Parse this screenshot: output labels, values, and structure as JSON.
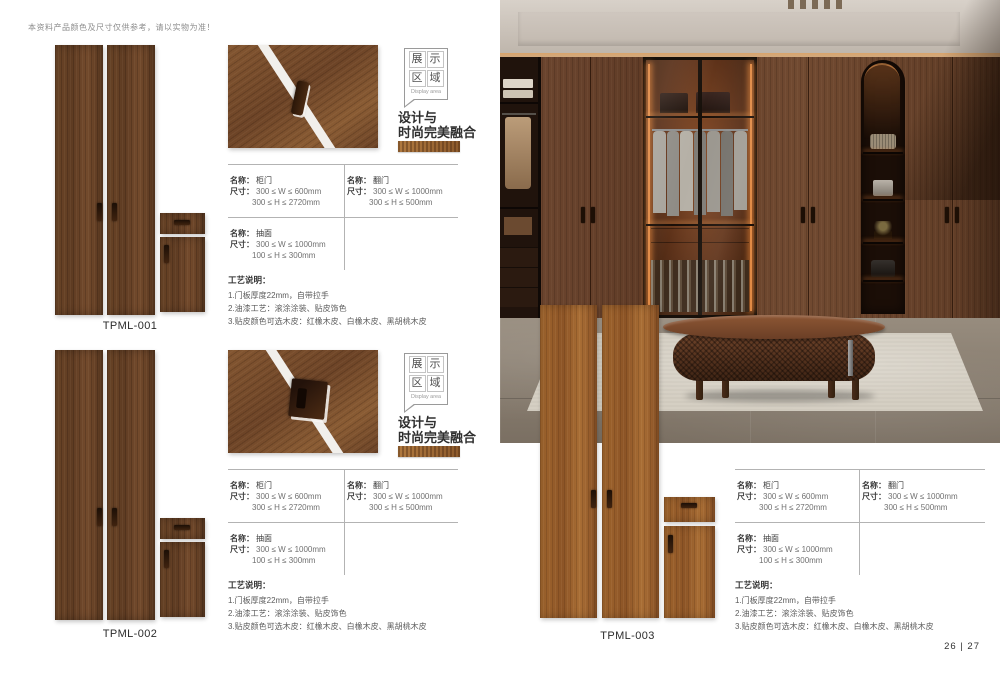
{
  "page": {
    "disclaimer": "本资料产品颜色及尺寸仅供参考，请以实物为准！",
    "page_number": "26 | 27"
  },
  "labels": {
    "name": "名称：",
    "size": "尺寸："
  },
  "badge": {
    "chars": [
      "展",
      "示",
      "区",
      "域"
    ],
    "subtitle": "Display area"
  },
  "tagline": {
    "line1": "设计与",
    "line2": "时尚完美融合"
  },
  "craft": {
    "title": "工艺说明：",
    "line1": "1.门板厚度22mm，自带拉手",
    "line2": "2.油漆工艺：滚涂涂装、贴皮饰色",
    "line3": "3.贴皮颜色可选木皮：红橡木皮、白橡木皮、黑胡桃木皮"
  },
  "specs": {
    "cabinet_door": {
      "name": "柜门",
      "w": "300 ≤ W ≤ 600mm",
      "h": "300 ≤ H ≤ 2720mm"
    },
    "flip_door": {
      "name": "翻门",
      "w": "300 ≤ W ≤ 1000mm",
      "h": "300 ≤ H ≤ 500mm"
    },
    "drawer_face": {
      "name": "抽面",
      "w": "300 ≤ W ≤ 1000mm",
      "h": "100 ≤ H ≤ 300mm"
    }
  },
  "products": [
    {
      "code": "TPML-001"
    },
    {
      "code": "TPML-002"
    },
    {
      "code": "TPML-003"
    }
  ],
  "colors": {
    "walnut_dark": "#6b4428",
    "teak_light": "#9d6230",
    "warm_glow": "#e08a45",
    "table_line": "#b3b3b3"
  }
}
